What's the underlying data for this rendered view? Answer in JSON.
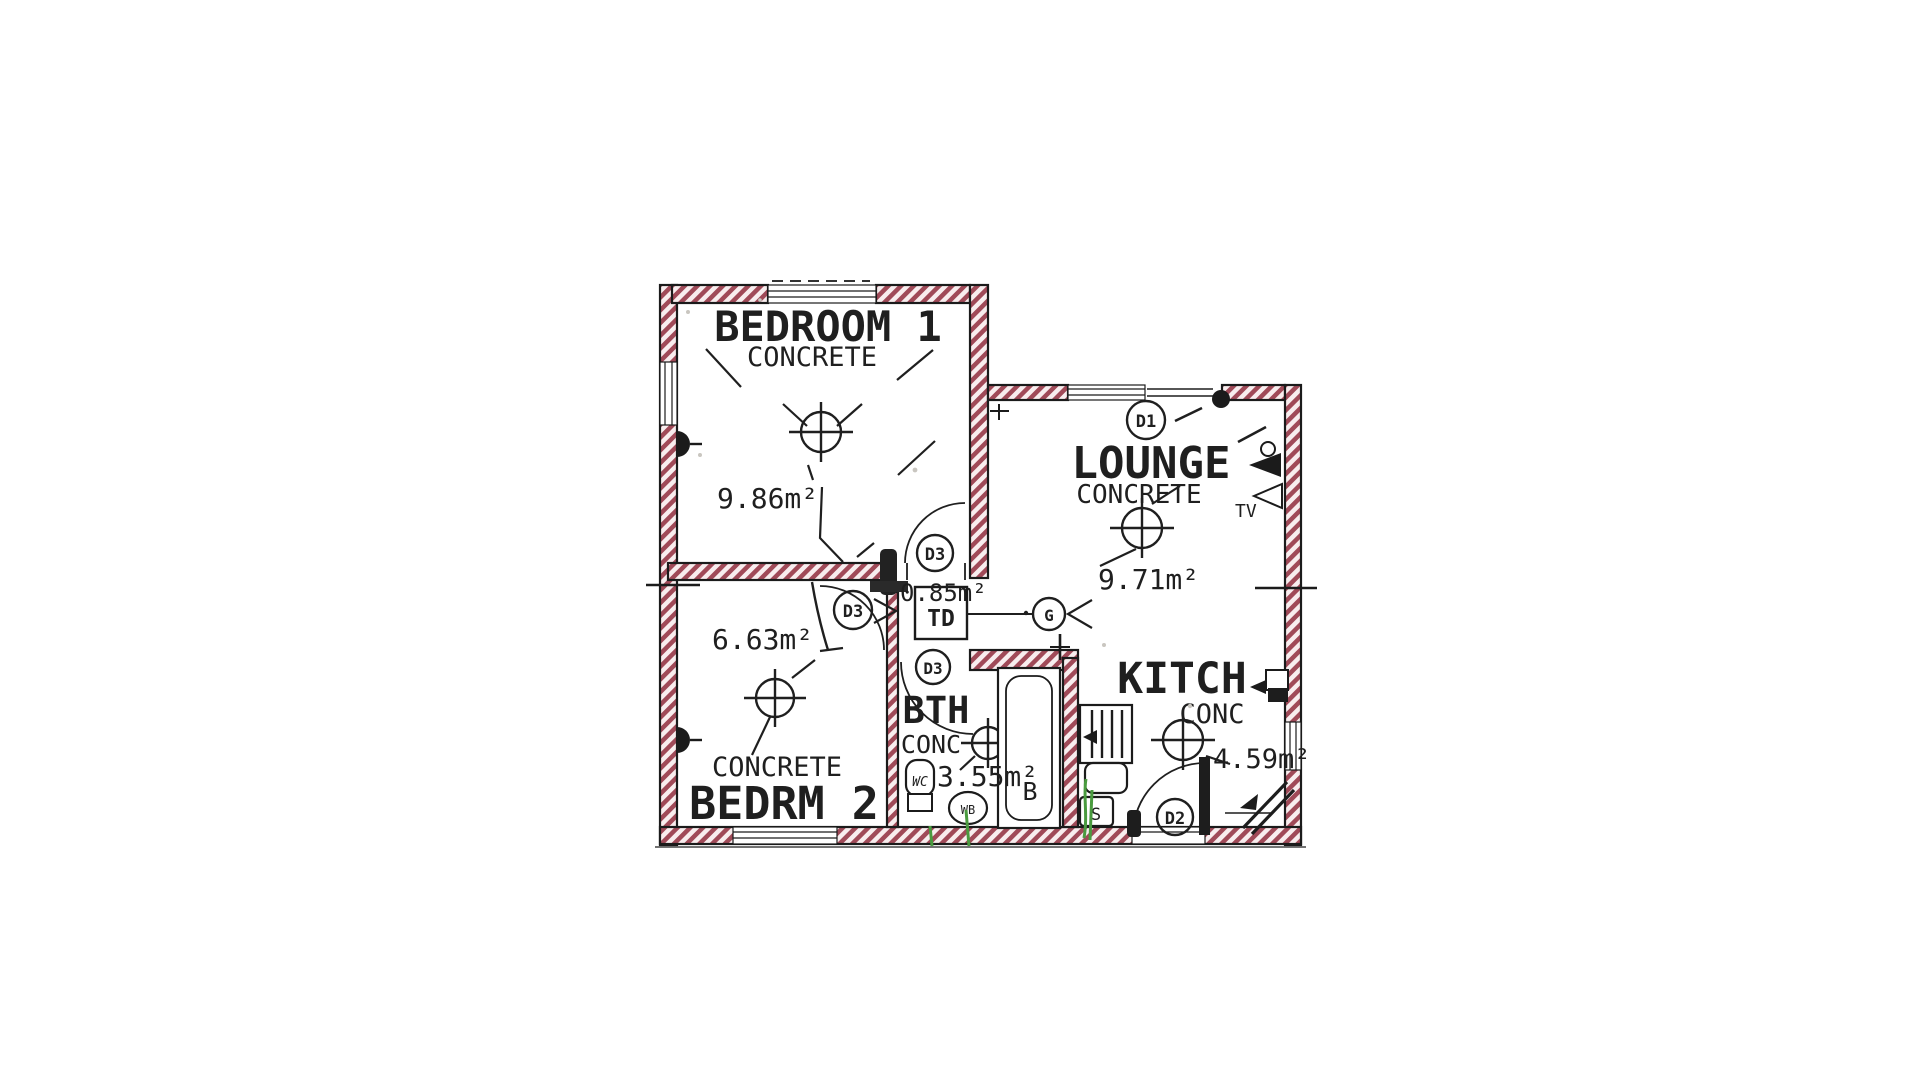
{
  "document": {
    "kind": "scanned floor plan drawing"
  },
  "colors": {
    "paper": "#ffffff",
    "ink": "#1f1f1f",
    "wall_hatch": "#a04a58",
    "wall_hatch_bg": "#f8edee",
    "green_mark": "#4a9b3f"
  },
  "rooms": [
    {
      "name": "BEDROOM 1",
      "floor": "CONCRETE",
      "area": "9.86m²"
    },
    {
      "name": "BEDRM 2",
      "floor": "CONCRETE",
      "area": "6.63m²"
    },
    {
      "name": "LOUNGE",
      "floor": "CONCRETE",
      "area": "9.71m²"
    },
    {
      "name": "BTH",
      "floor": "CONC",
      "area": "3.55m²"
    },
    {
      "name": "KITCH",
      "floor": "CONC",
      "area": "4.59m²"
    },
    {
      "name": "LOBBY",
      "floor": "",
      "area": "0.85m²"
    }
  ],
  "door_tags": {
    "d1": "D1",
    "d2": "D2",
    "d3": "D3",
    "g": "G"
  },
  "fixtures": {
    "tumble_dryer": "TD",
    "tv": "TV",
    "wc": "WC",
    "wash_basin": "WB",
    "bath": "B",
    "sink": "S"
  }
}
